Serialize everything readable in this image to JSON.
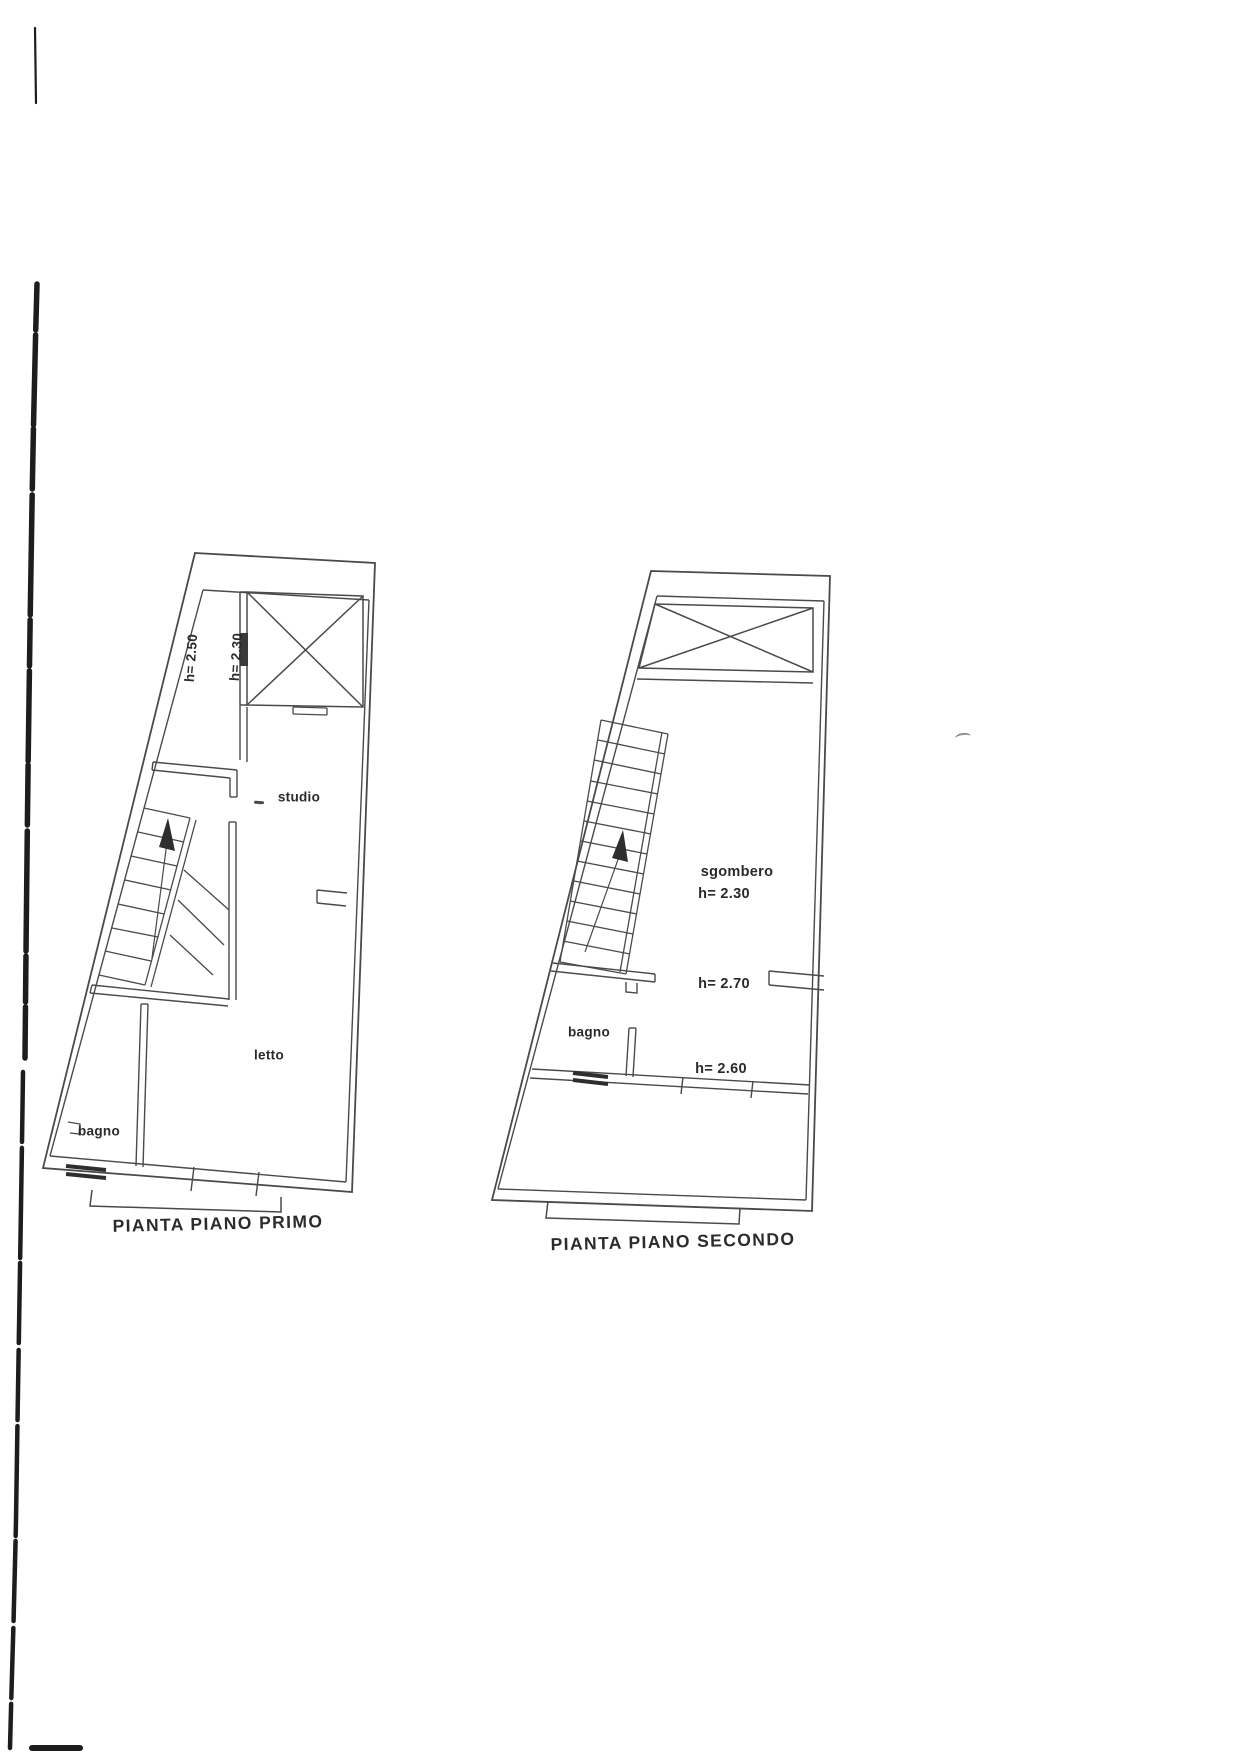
{
  "page": {
    "background": "#ffffff",
    "line_color": "#4a4a4a",
    "dark_line_color": "#2e2e2e",
    "text_color": "#2a2a2a"
  },
  "plans": {
    "first": {
      "title": "PIANTA PIANO PRIMO",
      "rooms": [
        "studio",
        "letto",
        "bagno"
      ],
      "heights": [
        "h= 2.50",
        "h= 2.30"
      ]
    },
    "second": {
      "title": "PIANTA PIANO SECONDO",
      "rooms": [
        "sgombero",
        "bagno"
      ],
      "heights": [
        "h= 2.30",
        "h= 2.70",
        "h= 2.60"
      ]
    }
  }
}
